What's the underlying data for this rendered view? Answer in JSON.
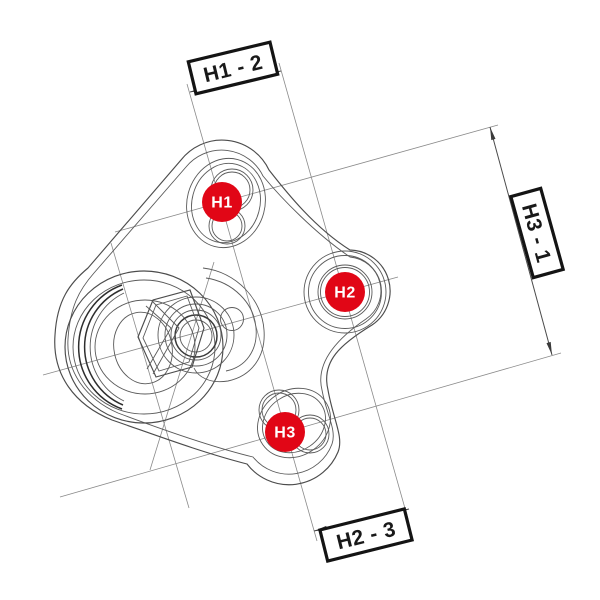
{
  "drawing": {
    "markers": [
      {
        "id": "H1",
        "label": "H1"
      },
      {
        "id": "H2",
        "label": "H2"
      },
      {
        "id": "H3",
        "label": "H3"
      }
    ],
    "dimensions": {
      "top": {
        "label": "H1 - 2"
      },
      "right": {
        "label": "H3 - 1"
      },
      "bottom": {
        "label": "H2 - 3"
      }
    },
    "colors": {
      "marker_fill": "#e10616",
      "marker_text": "#ffffff",
      "label_border": "#141414",
      "label_text": "#191919",
      "line": "#4c4c4c",
      "background": "#ffffff"
    }
  }
}
